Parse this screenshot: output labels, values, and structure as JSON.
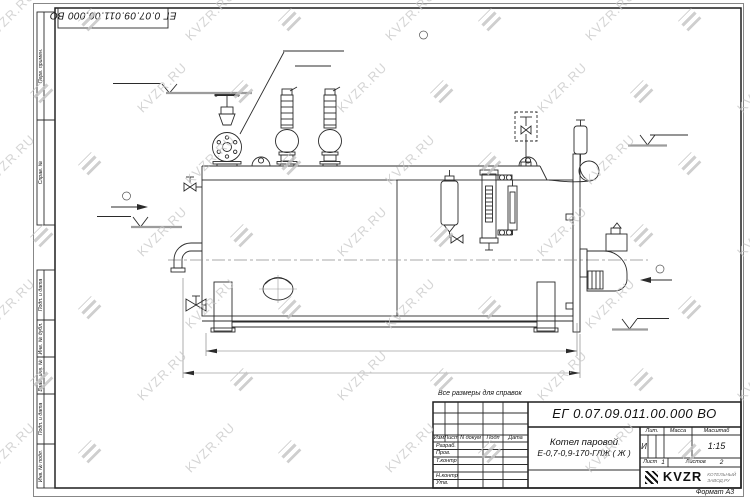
{
  "watermark": {
    "text": "KVZR.RU"
  },
  "frame": {
    "doc_number_top": "ЕГ 0.07.09.011.00.000 ВО",
    "left_margin": {
      "top_cells": [
        "Перв. примен.",
        "Справ. №"
      ],
      "bottom_cells": [
        "Подп. и дата",
        "Инв. № дубл.",
        "Взам. инв. №",
        "Подп. и дата",
        "Инв. № подл."
      ]
    },
    "format_label": "Формат А3"
  },
  "drawing": {
    "callout": {
      "line1": "Отвод пара",
      "line2": "Ду 50"
    },
    "view_markers": [
      {
        "label": "А"
      },
      {
        "label": "Б"
      },
      {
        "label": "В"
      }
    ],
    "levels": [
      {
        "value": "+2,115"
      },
      {
        "value": "1,630"
      },
      {
        "value": "+0,592"
      },
      {
        "value": "0,000"
      }
    ],
    "dimensions": [
      {
        "value": "3350"
      },
      {
        "value": "3575"
      }
    ],
    "note": "Все размеры для справок"
  },
  "title_block": {
    "doc_number": "ЕГ 0.07.09.011.00.000 ВО",
    "name_line1": "Котел паровой",
    "name_line2": "Е-0,7-0,9-170-ГЛЖ ( Ж )",
    "columns": {
      "izm": "Изм",
      "list": "Лист",
      "n_dokum": "N докум",
      "podp": "Подп",
      "data": "Дата"
    },
    "rows": [
      "Разраб.",
      "Пров.",
      "Т.контр",
      "",
      "Н.контр",
      "Утв."
    ],
    "lit_header": "Лит.",
    "massa_header": "Масса",
    "masshtab_header": "Масштаб",
    "lit_value": "И",
    "scale": "1:15",
    "sheet_label": "Лист",
    "sheet_value": "1",
    "sheets_label": "Листов",
    "sheets_value": "2",
    "logo_text": "KVZR",
    "logo_sub1": "КОТЕЛЬНЫЙ",
    "logo_sub2": "ЗАВОД.РУ"
  }
}
